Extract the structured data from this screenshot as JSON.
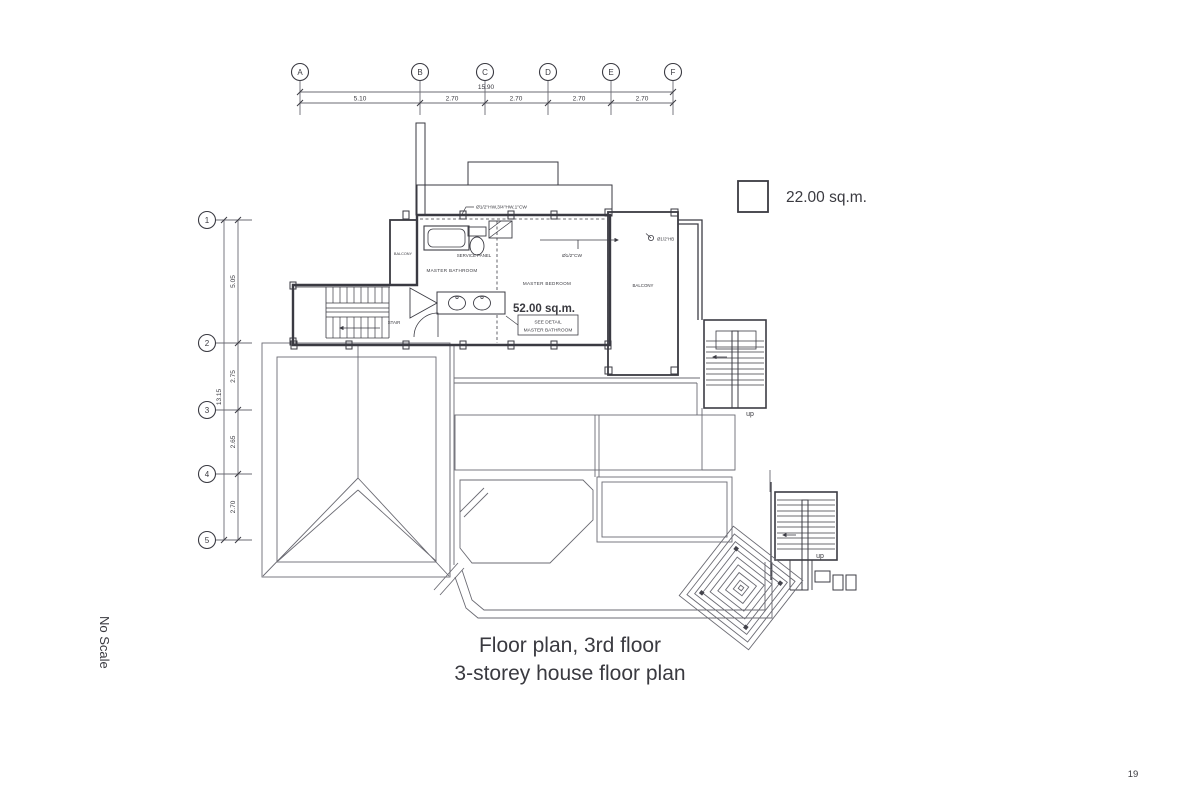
{
  "page": {
    "number": "19",
    "scale_note": "No Scale"
  },
  "titles": {
    "line1": "Floor plan, 3rd floor",
    "line2": "3-storey house floor plan"
  },
  "legend": {
    "area": "22.00 sq.m.",
    "swatch_color": "#f7c9f3"
  },
  "grid": {
    "columns": [
      "A",
      "B",
      "C",
      "D",
      "E",
      "F"
    ],
    "column_total": "15.90",
    "column_dims": [
      "5.10",
      "2.70",
      "2.70",
      "2.70",
      "2.70"
    ],
    "rows": [
      "1",
      "2",
      "3",
      "4",
      "5"
    ],
    "row_total": "13.15",
    "row_dims": [
      "5.05",
      "2.75",
      "2.65",
      "2.70"
    ]
  },
  "plan": {
    "labels": {
      "master_bathroom": "MASTER BATHROOM",
      "master_bedroom": "MASTER BEDROOM",
      "service_panel": "SERVICE PANEL",
      "stair": "STAIR",
      "balcony_left": "BALCONY",
      "balcony_right": "BALCONY",
      "see_detail_1": "SEE DETAIL",
      "see_detail_2": "MASTER BATHROOM",
      "up": "up",
      "pipe_main": "Ø1/2\"HW,3/4\"HW,1\"CW",
      "pipe_cw": "Ø1/2\"CW",
      "hose_bib": "Ø1/2\"HB"
    },
    "areas": {
      "bedroom": "52.00 sq.m."
    },
    "colors": {
      "balcony": "#f7c9f3",
      "floor": "#eaeedb",
      "accent": "#cc2f28"
    }
  }
}
